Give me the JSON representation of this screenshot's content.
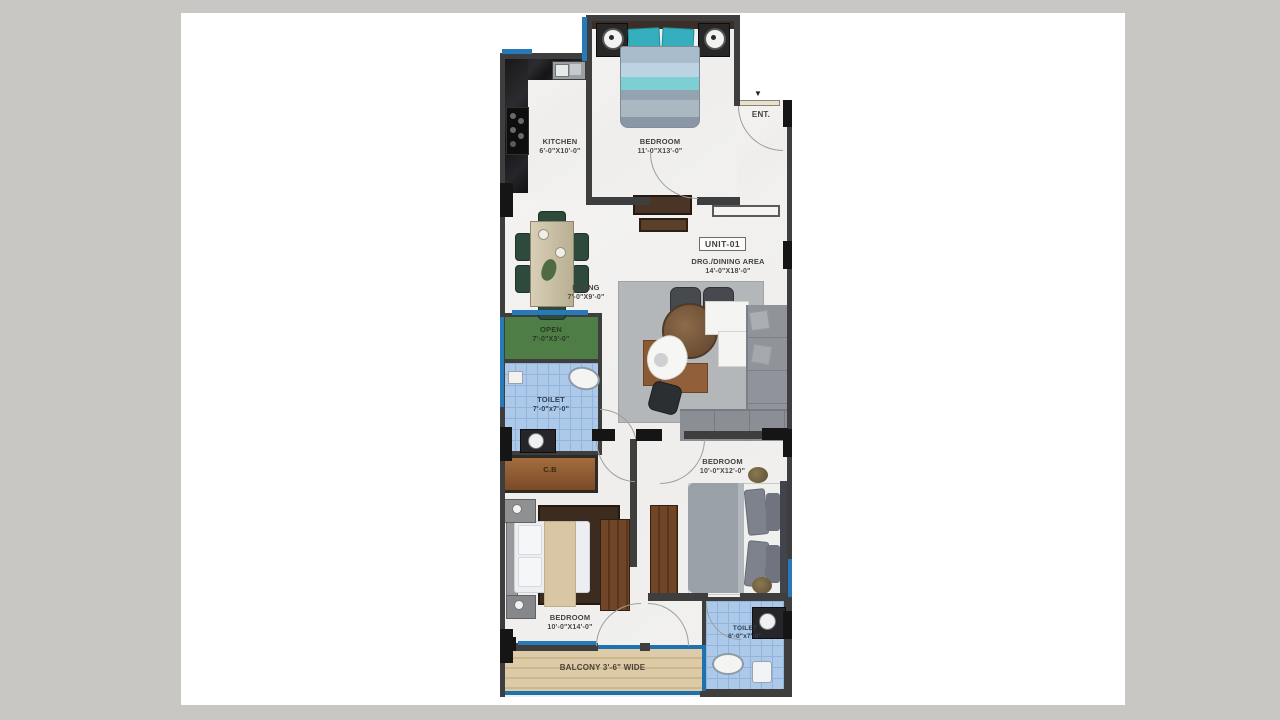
{
  "unit": {
    "label": "UNIT-01"
  },
  "rooms": {
    "kitchen": {
      "name": "KITCHEN",
      "dims": "6'-0\"X10'-0\""
    },
    "bedroom_top": {
      "name": "BEDROOM",
      "dims": "11'-0\"X13'-0\""
    },
    "entrance": {
      "name": "ENT."
    },
    "drg_dining": {
      "name": "DRG./DINING AREA",
      "dims": "14'-0\"X18'-0\""
    },
    "dining": {
      "name": "DINING",
      "dims": "7'-0\"X9'-0\""
    },
    "open_area": {
      "name": "OPEN",
      "dims": "7'-0\"X3'-0\""
    },
    "toilet_mid": {
      "name": "TOILET",
      "dims": "7'-0\"x7'-0\""
    },
    "cupboard": {
      "name": "C.B"
    },
    "bedroom_right": {
      "name": "BEDROOM",
      "dims": "10'-0\"X12'-0\""
    },
    "bedroom_bottom": {
      "name": "BEDROOM",
      "dims": "10'-0\"X14'-0\""
    },
    "toilet_bottom": {
      "name": "TOILET",
      "dims": "6'-0\"x7'-0\""
    },
    "balcony": {
      "name": "BALCONY 3'-6\" WIDE"
    }
  },
  "colors": {
    "background": "#c8c7c4",
    "canvas": "#ffffff",
    "wall": "#3e3e3e",
    "column": "#151515",
    "window_blue": "#2779b8",
    "tile_blue": "#adc9e9",
    "open_green": "#4e7d45",
    "balcony_wood": "#ddcba7",
    "accent_teal": "#3fb3c2"
  }
}
